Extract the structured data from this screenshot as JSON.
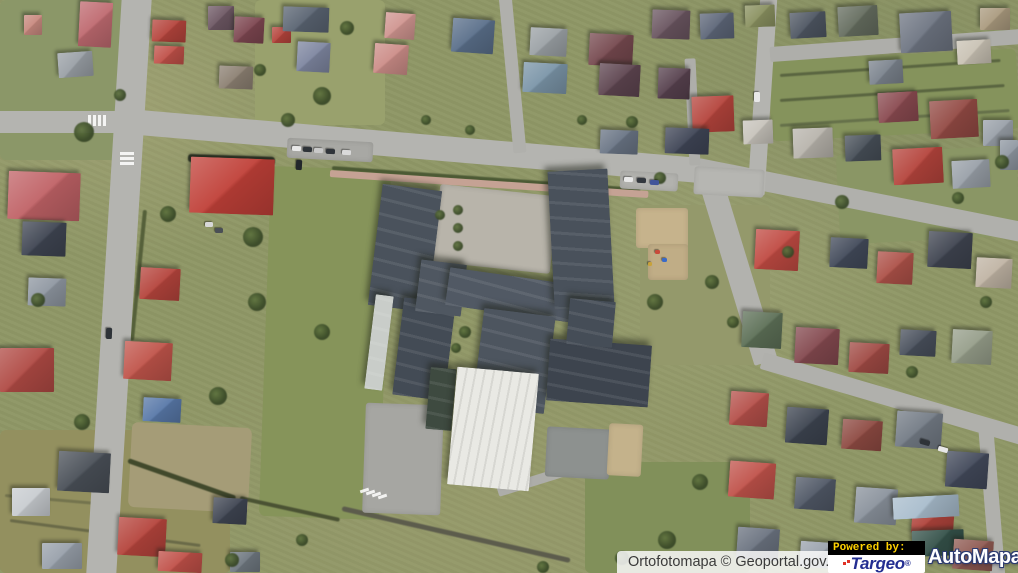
{
  "attribution": {
    "text": "Ortofotomapa © Geoportal.gov.pl"
  },
  "powered_by": {
    "label": "Powered by:",
    "targeo": {
      "name": "Targeo",
      "reg": "®",
      "color": "#232e91",
      "accent": "#e03226"
    },
    "automapa": {
      "name": "AutoMapa",
      "reg": "®",
      "color": "#ffffff",
      "outline": "#2b3a71"
    }
  },
  "map": {
    "description": "aerial orthophoto of a residential district with a large school complex",
    "base_color": "#8f9766",
    "terrain": [
      [
        0,
        0,
        140,
        160,
        0,
        "#8b9768"
      ],
      [
        255,
        0,
        130,
        125,
        0,
        "#99a16d"
      ],
      [
        265,
        168,
        120,
        350,
        2,
        "#86945a"
      ],
      [
        0,
        430,
        230,
        143,
        0,
        "#93905f"
      ],
      [
        585,
        462,
        165,
        111,
        0,
        "#81905a"
      ],
      [
        770,
        55,
        248,
        80,
        -3,
        "#85935c"
      ],
      [
        640,
        205,
        130,
        160,
        0,
        "#94996b"
      ],
      [
        130,
        425,
        120,
        85,
        3,
        "#a59c77"
      ],
      [
        838,
        150,
        180,
        90,
        -3,
        "#8a9665"
      ]
    ],
    "hedges": [
      [
        332,
        168,
        640,
        190,
        4,
        "#4c5a34"
      ],
      [
        128,
        460,
        236,
        498,
        5,
        "#41492c"
      ],
      [
        240,
        498,
        340,
        520,
        4,
        "#4a5233"
      ],
      [
        145,
        210,
        132,
        340,
        4,
        "#55603a"
      ],
      [
        188,
        158,
        275,
        161,
        8,
        "#2f3626"
      ],
      [
        780,
        75,
        1000,
        60,
        3,
        "#5a6540"
      ],
      [
        780,
        100,
        1005,
        85,
        3,
        "#5a6540"
      ],
      [
        780,
        125,
        1010,
        110,
        3,
        "#66714a"
      ],
      [
        10,
        520,
        200,
        545,
        3,
        "#6a6a48"
      ],
      [
        5,
        495,
        120,
        505,
        3,
        "#74744e"
      ],
      [
        342,
        508,
        570,
        560,
        5,
        "#5c5c4c"
      ]
    ],
    "roads": [
      [
        -5,
        122,
        125,
        122,
        22,
        "#b4b4b0"
      ],
      [
        137,
        -6,
        101,
        578,
        30,
        "#b4b4b0"
      ],
      [
        116,
        120,
        700,
        170,
        25,
        "#b4b4b0"
      ],
      [
        698,
        168,
        1022,
        232,
        20,
        "#b0b0ac"
      ],
      [
        769,
        -6,
        756,
        195,
        17,
        "#b4b4b0"
      ],
      [
        770,
        54,
        1022,
        36,
        15,
        "#aeaeaa"
      ],
      [
        505,
        -6,
        520,
        152,
        13,
        "#b0b0ac"
      ],
      [
        690,
        58,
        695,
        165,
        11,
        "#aeaeaa"
      ],
      [
        708,
        172,
        766,
        362,
        24,
        "#b2b2ae"
      ],
      [
        762,
        360,
        1022,
        436,
        17,
        "#b0b0ac"
      ],
      [
        986,
        430,
        998,
        578,
        15,
        "#b0b0ac"
      ],
      [
        330,
        173,
        648,
        194,
        7,
        "#c5a294"
      ],
      [
        498,
        492,
        640,
        448,
        10,
        "#adada9"
      ]
    ],
    "paved": [
      [
        436,
        190,
        118,
        78,
        6,
        "#b8b4aa"
      ],
      [
        364,
        404,
        78,
        110,
        2,
        "#a6a6a2"
      ],
      [
        546,
        428,
        64,
        50,
        3,
        "#8d918f"
      ],
      [
        608,
        424,
        34,
        52,
        3,
        "#c4b28b"
      ],
      [
        636,
        208,
        52,
        40,
        0,
        "#c6b38c"
      ],
      [
        648,
        244,
        40,
        36,
        0,
        "#c0ad86"
      ],
      [
        287,
        140,
        86,
        20,
        3,
        "#a8a8a4"
      ],
      [
        694,
        168,
        70,
        28,
        3,
        "#b6b6b2"
      ],
      [
        620,
        172,
        58,
        18,
        3,
        "#b2b2ae"
      ]
    ],
    "school": [
      [
        375,
        187,
        60,
        122,
        7,
        "#4a525c",
        ""
      ],
      [
        398,
        300,
        52,
        98,
        7,
        "#434b55",
        ""
      ],
      [
        418,
        262,
        46,
        52,
        7,
        "#4f5761",
        ""
      ],
      [
        447,
        276,
        128,
        38,
        8,
        "#515964",
        ""
      ],
      [
        551,
        170,
        60,
        138,
        -3,
        "#49515b",
        ""
      ],
      [
        478,
        312,
        72,
        98,
        7,
        "#4d555f",
        ""
      ],
      [
        548,
        342,
        102,
        62,
        4,
        "#3d444e",
        ""
      ],
      [
        568,
        300,
        46,
        46,
        5,
        "#454d57",
        ""
      ],
      [
        370,
        295,
        18,
        95,
        7,
        "#c9cdc9",
        ""
      ],
      [
        428,
        368,
        26,
        62,
        5,
        "#3e4a40",
        ""
      ],
      [
        452,
        370,
        82,
        118,
        5,
        "#e9e9e4",
        "hall"
      ]
    ],
    "houses": [
      [
        79,
        2,
        33,
        45,
        3,
        "#bf6a70"
      ],
      [
        24,
        15,
        18,
        20,
        0,
        "#c8897f"
      ],
      [
        58,
        52,
        35,
        25,
        -4,
        "#9aa0a6"
      ],
      [
        152,
        20,
        34,
        22,
        2,
        "#b5443c"
      ],
      [
        154,
        46,
        30,
        18,
        2,
        "#c05048"
      ],
      [
        208,
        6,
        26,
        24,
        0,
        "#6e5864"
      ],
      [
        234,
        17,
        30,
        26,
        3,
        "#7d4650"
      ],
      [
        272,
        27,
        19,
        16,
        0,
        "#b5443c"
      ],
      [
        283,
        7,
        46,
        25,
        2,
        "#5a6472"
      ],
      [
        297,
        42,
        33,
        30,
        3,
        "#7e86a0"
      ],
      [
        219,
        66,
        34,
        23,
        2,
        "#8c8072"
      ],
      [
        385,
        13,
        30,
        26,
        4,
        "#d09590"
      ],
      [
        374,
        44,
        34,
        30,
        4,
        "#cc8d88"
      ],
      [
        452,
        19,
        42,
        34,
        4,
        "#5a6f8a"
      ],
      [
        530,
        28,
        37,
        28,
        3,
        "#9ba1a5"
      ],
      [
        523,
        63,
        44,
        30,
        3,
        "#7b95a8"
      ],
      [
        589,
        34,
        44,
        32,
        3,
        "#76494f"
      ],
      [
        599,
        64,
        41,
        32,
        3,
        "#5e4550"
      ],
      [
        652,
        10,
        38,
        29,
        2,
        "#6a5560"
      ],
      [
        658,
        68,
        32,
        31,
        2,
        "#57414e"
      ],
      [
        700,
        13,
        34,
        26,
        -2,
        "#5d6678"
      ],
      [
        745,
        5,
        30,
        22,
        -2,
        "#8a9160"
      ],
      [
        790,
        12,
        36,
        26,
        -3,
        "#4e5662"
      ],
      [
        838,
        6,
        40,
        30,
        -3,
        "#656d5f"
      ],
      [
        900,
        12,
        52,
        40,
        -3,
        "#6e7582"
      ],
      [
        957,
        40,
        34,
        24,
        -3,
        "#c9c2b4"
      ],
      [
        869,
        60,
        34,
        24,
        -3,
        "#7b838d"
      ],
      [
        980,
        8,
        30,
        22,
        0,
        "#aa9a7e"
      ],
      [
        692,
        96,
        42,
        36,
        -2,
        "#b5443c"
      ],
      [
        743,
        120,
        30,
        24,
        -2,
        "#c7c3bb"
      ],
      [
        878,
        92,
        40,
        30,
        -3,
        "#8a4a50"
      ],
      [
        930,
        100,
        48,
        38,
        -3,
        "#934a44"
      ],
      [
        983,
        120,
        30,
        26,
        0,
        "#99a0a8"
      ],
      [
        665,
        128,
        44,
        26,
        2,
        "#3f4556"
      ],
      [
        600,
        130,
        38,
        24,
        2,
        "#6a7585"
      ],
      [
        793,
        128,
        40,
        30,
        -2,
        "#b8b4ac"
      ],
      [
        845,
        135,
        36,
        26,
        -2,
        "#474f58"
      ],
      [
        893,
        148,
        50,
        36,
        -3,
        "#b5443c"
      ],
      [
        952,
        160,
        38,
        28,
        -3,
        "#99a0a8"
      ],
      [
        1000,
        140,
        18,
        30,
        0,
        "#8f97a1"
      ],
      [
        755,
        230,
        44,
        40,
        3,
        "#c04a42"
      ],
      [
        830,
        238,
        38,
        30,
        3,
        "#424a5a"
      ],
      [
        877,
        252,
        36,
        32,
        3,
        "#ad5148"
      ],
      [
        928,
        232,
        44,
        36,
        3,
        "#3f4450"
      ],
      [
        976,
        258,
        36,
        30,
        3,
        "#c0b4a4"
      ],
      [
        742,
        312,
        40,
        36,
        3,
        "#5d7057"
      ],
      [
        795,
        328,
        44,
        36,
        3,
        "#84494f"
      ],
      [
        849,
        343,
        40,
        30,
        3,
        "#a04a44"
      ],
      [
        900,
        330,
        36,
        26,
        3,
        "#49505c"
      ],
      [
        952,
        330,
        40,
        34,
        3,
        "#969e8a"
      ],
      [
        730,
        392,
        38,
        34,
        4,
        "#b5504a"
      ],
      [
        786,
        408,
        42,
        36,
        4,
        "#3d4450"
      ],
      [
        842,
        420,
        40,
        30,
        4,
        "#8e4a42"
      ],
      [
        896,
        412,
        46,
        36,
        4,
        "#737b85"
      ],
      [
        946,
        452,
        42,
        36,
        4,
        "#42495a"
      ],
      [
        729,
        462,
        46,
        36,
        4,
        "#c0524a"
      ],
      [
        795,
        478,
        40,
        32,
        4,
        "#505866"
      ],
      [
        855,
        488,
        42,
        36,
        4,
        "#8a929c"
      ],
      [
        912,
        502,
        42,
        32,
        4,
        "#b0443c"
      ],
      [
        893,
        496,
        66,
        22,
        -3,
        "#a8bccc"
      ],
      [
        912,
        530,
        52,
        26,
        -2,
        "#35524a"
      ],
      [
        737,
        528,
        42,
        32,
        4,
        "#6b7380"
      ],
      [
        800,
        542,
        38,
        26,
        4,
        "#9aa2ac"
      ],
      [
        864,
        548,
        40,
        22,
        4,
        "#4d5560"
      ],
      [
        953,
        540,
        40,
        30,
        4,
        "#8f5a52"
      ],
      [
        8,
        172,
        72,
        48,
        2,
        "#c06266"
      ],
      [
        190,
        158,
        84,
        56,
        2,
        "#c04038"
      ],
      [
        22,
        222,
        44,
        34,
        2,
        "#3f4552"
      ],
      [
        28,
        278,
        38,
        28,
        2,
        "#8f97a1"
      ],
      [
        0,
        348,
        54,
        44,
        0,
        "#b04a44"
      ],
      [
        140,
        268,
        40,
        32,
        3,
        "#b5443c"
      ],
      [
        124,
        342,
        48,
        38,
        3,
        "#c0544a"
      ],
      [
        143,
        398,
        38,
        24,
        3,
        "#5878a8"
      ],
      [
        58,
        452,
        52,
        40,
        3,
        "#4a5058"
      ],
      [
        12,
        488,
        38,
        28,
        0,
        "#c8ccd0"
      ],
      [
        118,
        518,
        48,
        38,
        3,
        "#b5443c"
      ],
      [
        158,
        552,
        44,
        20,
        3,
        "#c05048"
      ],
      [
        42,
        543,
        40,
        26,
        0,
        "#98a0aa"
      ],
      [
        213,
        498,
        34,
        26,
        3,
        "#3f4552"
      ],
      [
        230,
        552,
        30,
        20,
        0,
        "#6f7880"
      ]
    ],
    "markings": [
      [
        88,
        115,
        3,
        11,
        0,
        "#ffffff"
      ],
      [
        93,
        115,
        3,
        11,
        0,
        "#ffffff"
      ],
      [
        98,
        115,
        3,
        11,
        0,
        "#ffffff"
      ],
      [
        103,
        115,
        3,
        11,
        0,
        "#ffffff"
      ],
      [
        120,
        152,
        14,
        3,
        0,
        "#ffffff"
      ],
      [
        120,
        157,
        14,
        3,
        0,
        "#ffffff"
      ],
      [
        120,
        162,
        14,
        3,
        0,
        "#ffffff"
      ],
      [
        363,
        486,
        3,
        9,
        72,
        "#ffffff"
      ],
      [
        369,
        488,
        3,
        9,
        72,
        "#ffffff"
      ],
      [
        375,
        490,
        3,
        9,
        72,
        "#ffffff"
      ],
      [
        381,
        492,
        3,
        9,
        72,
        "#ffffff"
      ]
    ],
    "trees": [
      [
        322,
        96,
        9
      ],
      [
        347,
        28,
        7
      ],
      [
        84,
        132,
        10
      ],
      [
        168,
        214,
        8
      ],
      [
        253,
        237,
        10
      ],
      [
        257,
        302,
        9
      ],
      [
        322,
        332,
        8
      ],
      [
        218,
        396,
        9
      ],
      [
        82,
        422,
        8
      ],
      [
        38,
        300,
        7
      ],
      [
        660,
        178,
        6
      ],
      [
        655,
        302,
        8
      ],
      [
        712,
        282,
        7
      ],
      [
        733,
        322,
        6
      ],
      [
        842,
        202,
        7
      ],
      [
        958,
        198,
        6
      ],
      [
        1002,
        162,
        7
      ],
      [
        788,
        252,
        6
      ],
      [
        700,
        482,
        8
      ],
      [
        667,
        540,
        9
      ],
      [
        622,
        558,
        7
      ],
      [
        543,
        567,
        6
      ],
      [
        232,
        560,
        7
      ],
      [
        302,
        540,
        6
      ],
      [
        465,
        332,
        6
      ],
      [
        456,
        348,
        5
      ],
      [
        632,
        122,
        6
      ],
      [
        582,
        120,
        5
      ],
      [
        912,
        372,
        6
      ],
      [
        986,
        302,
        6
      ],
      [
        288,
        120,
        7
      ],
      [
        260,
        70,
        6
      ],
      [
        120,
        95,
        6
      ],
      [
        426,
        120,
        5
      ],
      [
        470,
        130,
        5
      ],
      [
        458,
        210,
        5
      ],
      [
        458,
        228,
        5
      ],
      [
        458,
        246,
        5
      ],
      [
        440,
        215,
        5
      ]
    ],
    "cars": [
      [
        292,
        146,
        9,
        5,
        3,
        "#e8e8e8"
      ],
      [
        303,
        147,
        9,
        5,
        3,
        "#2e3338"
      ],
      [
        314,
        148,
        9,
        5,
        3,
        "#c9c9c9"
      ],
      [
        326,
        149,
        9,
        5,
        3,
        "#30343a"
      ],
      [
        342,
        150,
        9,
        5,
        3,
        "#dadada"
      ],
      [
        296,
        160,
        6,
        10,
        3,
        "#22262b"
      ],
      [
        624,
        177,
        9,
        5,
        2,
        "#e8e8e8"
      ],
      [
        637,
        178,
        9,
        5,
        2,
        "#33383e"
      ],
      [
        650,
        180,
        9,
        5,
        2,
        "#41549a"
      ],
      [
        106,
        328,
        6,
        11,
        2,
        "#2e3338"
      ],
      [
        754,
        92,
        6,
        10,
        0,
        "#e8e8e8"
      ],
      [
        920,
        440,
        10,
        5,
        16,
        "#2e3338"
      ],
      [
        938,
        447,
        10,
        5,
        16,
        "#e8e8e8"
      ],
      [
        205,
        222,
        8,
        5,
        0,
        "#d8d8d8"
      ],
      [
        215,
        228,
        8,
        5,
        0,
        "#4a4f55"
      ]
    ],
    "objects": [
      [
        655,
        250,
        5,
        4,
        0,
        "#c84a3a"
      ],
      [
        662,
        258,
        5,
        4,
        0,
        "#3a6ac8"
      ],
      [
        648,
        262,
        4,
        4,
        0,
        "#c8a23a"
      ]
    ]
  }
}
